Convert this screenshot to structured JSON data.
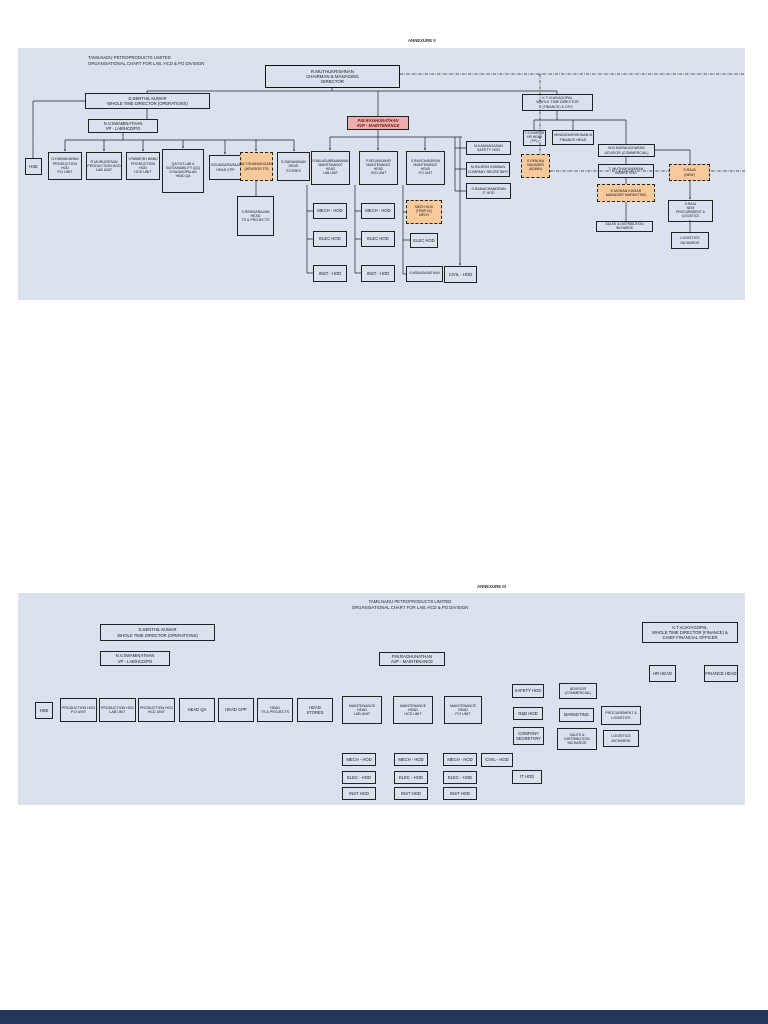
{
  "c1": {
    "annexure": "ANNEXURE II",
    "title": "TAMILNADU PETROPRODUCTS LIMITED\nORGANISATIONAL CHART FOR LAB, HCD & PO DIVISION",
    "md": "R.MUTHUKRISHNAN\nCHAIRMAN & MANAGING\nDIRECTOR",
    "wtd_ops": "D.SENTHIL KUMAR\nWHOLE TIME DIRECTOR (OPERATIONS)",
    "wtd_fin": "K.T.VIJAYAGOPAL\nWHOLE TIME DIRECTOR\n(FINANCE) & CFO",
    "vp_lab": "N.V.SWAMINATHAN\nVP - LAB/HCD/PO",
    "avp_maint": "P.M.RAGHUNATHAN\nAVP - MAINTENANCE",
    "hse": "HSE",
    "prod_po": "G.DHINAKARAN\nPRODUCTION HOD\nP.O UNIT",
    "prod_lab": "R.MURUGESAN\nPRODUCTION HOD\nLAB UNIT",
    "prod_hcd": "V.RAMESH BABU\nPRODUCTION HOD\nHCD UNIT",
    "head_qa": "QA/TS/T.LAB &\nSUSTAINABILITY (QC)\nS.RAJAGOPALAN\nHEAD QA",
    "head_cpp": "S.SOUNDARARAJAN\nHEAD CPP",
    "advisor_ts": "M.T.SHANMUGAM\n(ADVISOR TS)",
    "head_ts": "S.RENGARAJAN\nHEAD\nTS & PROJECTS",
    "head_stores": "S.SARAVANAN\nHEAD\nSTORES",
    "maint_lab": "R.BALASUBRAMANIAN\nMAINTENANCE\nHEAD\nLAB UNIT",
    "maint_hcd": "P.SELVAKUMAR\nMAINTENANCE\nHEAD\nHCD UNIT",
    "maint_po": "S.RAVICHANDRAN\nMAINTENANCE\nHEAD\nP.O UNIT",
    "m1_mech": "MECH - HOD",
    "m1_elec": "ELEC HOD",
    "m1_inst": "INST - HOD",
    "m2_mech": "MECH - HOD",
    "m2_elec": "ELEC HOD",
    "m2_inst": "INST - HOD",
    "m3_mech": "MECH HOD\n(TEMP I/C)\nMECH",
    "m3_elec": "ELEC HOD",
    "m3_name": "S.ARANGANATHAN",
    "civil": "CIVIL - HOD",
    "safety": "M.KANNADASAN\nSAFETY HOD",
    "compsec": "M.RAJESH KANNAN\nCOMPANY SECRETARY",
    "it_hod": "S.RAMACHANDRAN\nIT HOD",
    "mgr_admin": "G.RENUKA\nMANAGER (ADMIN)",
    "hr_head": "T.S.SURESH\nHR HEAD\n(TPL)",
    "fin_head": "VENKATAKRISHNAN M\nFINANCE HEAD",
    "advisor_comm": "M.B.MURALIDHARAN\nADVISOR (COMMERCIAL)",
    "marketing": "T. MUTHUKUMARAN\nMARKETING",
    "mgr_mktg": "K.MOHAN KUMAR\nMANAGER MARKETING",
    "sales_dist": "SALES & DISTRIBUTION INCHARGE",
    "raja_new": "S.RAJA\n(NEW)",
    "procurement": "S.RAJA\nNEW\nPROCUREMENT & LOGISTICS",
    "logistics": "LOGISTICS\nINCHARGE"
  },
  "c2": {
    "annexure": "ANNEXURE III",
    "title": "TAMILNADU PETROPRODUCTS LIMITED\nORGANISATIONAL CHART FOR LAB, HCD & PO DIVISION",
    "wtd_ops": "D.SENTHIL KUMAR\nWHOLE TIME DIRECTOR (OPERATIONS)",
    "wtd_fin": "K.T.VIJAYAGOPAL\nWHOLE TIME DIRECTOR (FINANCE) &\nCHIEF FINANCIAL OFFICER",
    "vp_lab": "N.V.SWAMINATHAN\nVP - LAB/HCD/PO",
    "avp_maint": "P.M.RAGHUNATHAN\nAVP - MAINTENANCE",
    "hse": "HSE",
    "r_po": "PRODUCTION HOD\nP.O UNIT",
    "r_lab": "PRODUCTION HOD\nLAB UNIT",
    "r_hcd": "PRODUCTION HOD\nHCD UNIT",
    "r_qa": "HEAD QA",
    "r_cpp": "HEAD CPP",
    "r_ts": "HEAD\nTS & PROJECTS",
    "r_stores": "HEAD\nSTORES",
    "mh_lab": "MAINTENANCE\nHEAD\nLAB UNIT",
    "mh_hcd": "MAINTENANCE\nHEAD\nHCD UNIT",
    "mh_po": "MAINTENANCE\nHEAD\nP.O UNIT",
    "safety": "SAFETY HOD",
    "rnd": "R&D HOD",
    "compsec": "COMPANY\nSECRETARY",
    "civil": "CIVIL - HOD",
    "it_hod": "IT HOD",
    "c1_mech": "MECH - HOD",
    "c1_elec": "ELEC - HOD",
    "c1_inst": "INST HOD",
    "c2_mech": "MECH - HOD",
    "c2_elec": "ELEC - HOD",
    "c2_inst": "INST HOD",
    "c3_mech": "MECH - HOD",
    "c3_elec": "ELEC - HOD",
    "c3_inst": "INST HOD",
    "advisor": "ADVISOR\n(COMMERCIAL)",
    "marketing": "MARKETING",
    "sales": "SALES &\nDISTRIBUTION\nINCHARGE",
    "procurement": "PROCUREMENT &\nLOGISTICS",
    "logistics": "LOGISTICS\nINCHARGE",
    "hr_head": "HR HEAD",
    "fin_head": "FINANCE HEAD"
  },
  "colors": {
    "panel_bg": "#dae2ee",
    "highlight_orange": "#f7c99b",
    "highlight_pink": "#eeacaa",
    "line": "#222222",
    "next_page_bar": "#25365a"
  }
}
